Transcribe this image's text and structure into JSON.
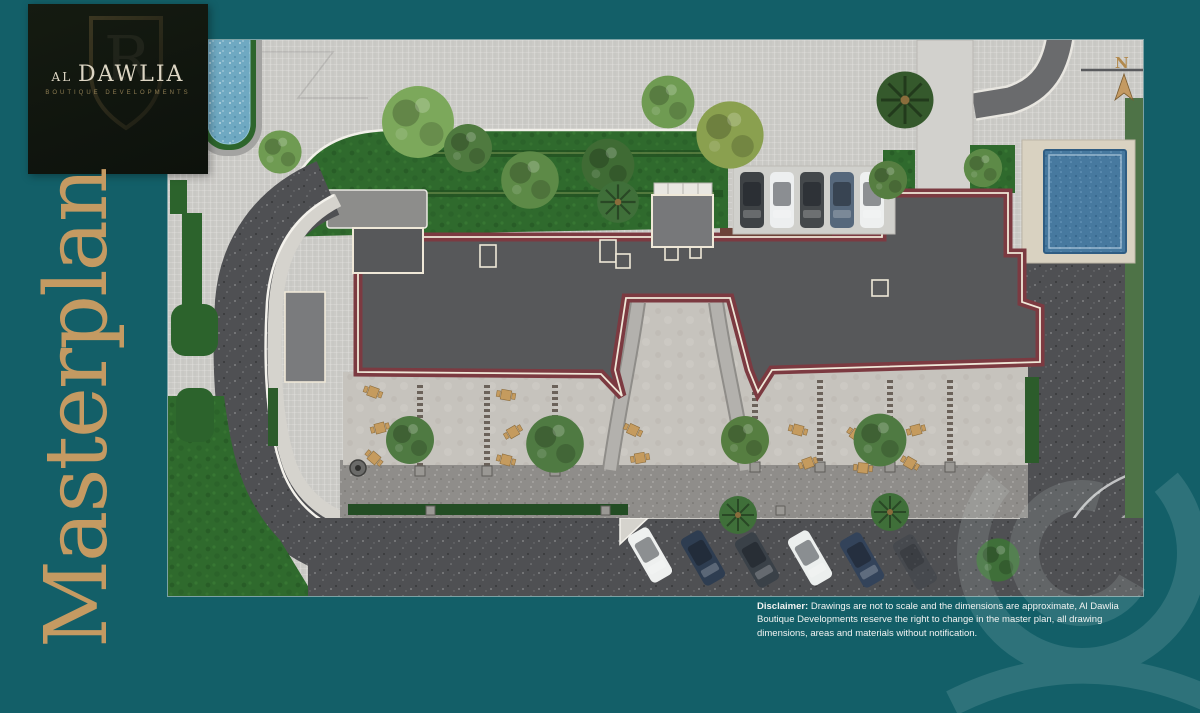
{
  "page": {
    "background_color": "#135f68",
    "accent_gold": "#c49a62"
  },
  "logo": {
    "title": "AL DAWLIA",
    "subtitle": "BOUTIQUE DEVELOPMENTS",
    "monogram": "R"
  },
  "title": {
    "text": "Masterplan",
    "color": "#c49a62"
  },
  "plan": {
    "compass_label": "N",
    "colors": {
      "paving": "#cac9c5",
      "lawn": "#2f6a2d",
      "asphalt": "#4f5053",
      "roof_gray": "#57585a",
      "trim_maroon": "#7c3a41",
      "trim_cream": "#efe8d8",
      "terrace": "#c6c3bd",
      "pool_water": "#47799f",
      "pool_deck": "#d9d2c1",
      "furniture_tan": "#c59b5e"
    },
    "parking_top": {
      "car_colors": [
        "#3e4245",
        "#edeff0",
        "#44484b",
        "#56687c",
        "#eef0f0"
      ]
    },
    "parking_bottom": {
      "car_colors": [
        "#eef0ef",
        "#2e3d51",
        "#3a4148",
        "#ecefee",
        "#33435a",
        "#3f444a"
      ]
    }
  },
  "disclaimer": {
    "label": "Disclaimer:",
    "text": " Drawings are not to scale and the dimensions are approximate, Al Dawlia Boutique Developments reserve the right to change in the master plan, all drawing dimensions, areas and materials without notification."
  }
}
